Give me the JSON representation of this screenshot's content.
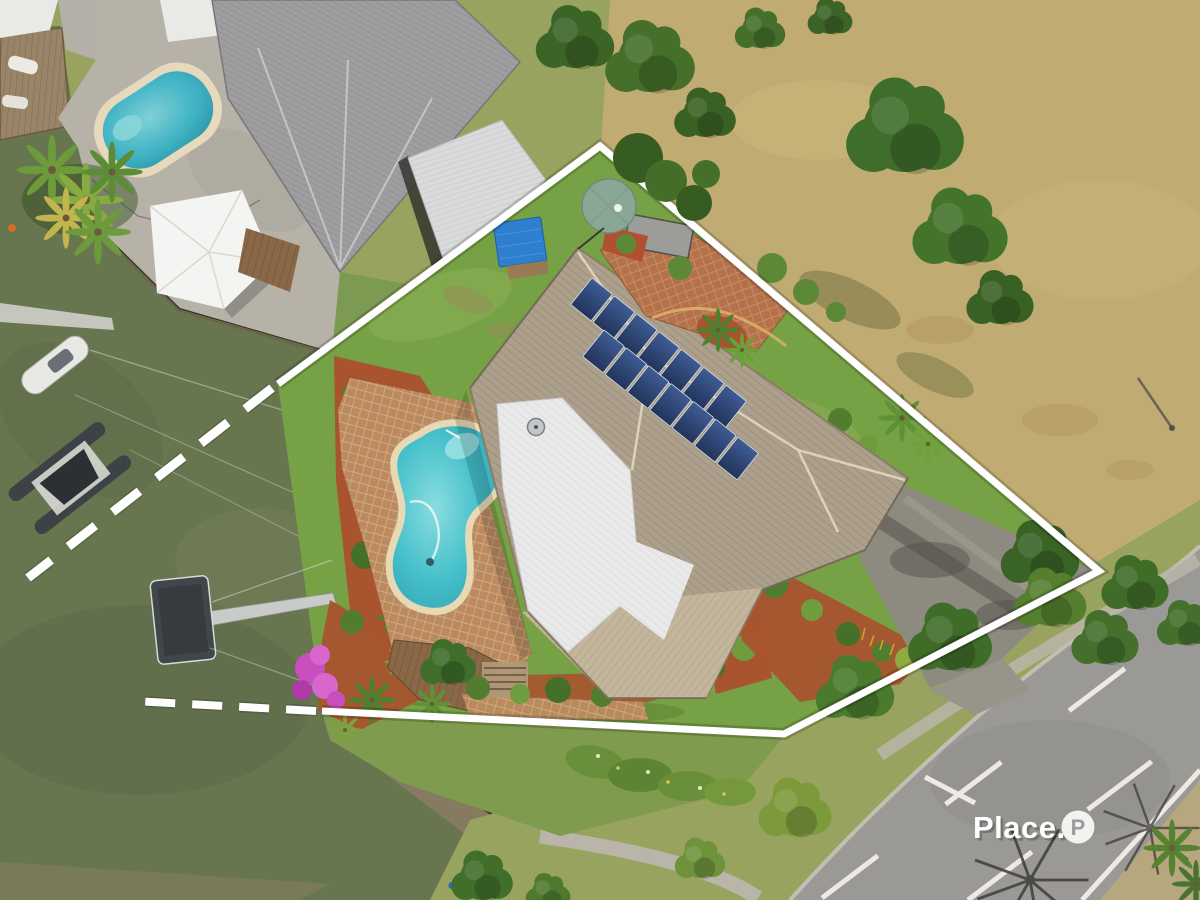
{
  "watermark": {
    "brand": "Place.",
    "badge_letter": "P"
  },
  "palette": {
    "water": "#68764f",
    "water_dark": "#5968444",
    "water_shallow": "#8a7f5f",
    "rocks": "#857b61",
    "seawall": "#23261f",
    "deck_concrete": "#b6b2a8",
    "dock_timber": "#9a8468",
    "lawn": "#76a145",
    "front_lawn": "#7f9c4e",
    "verge_grass": "#97a35e",
    "neighbor_lawn": "#7d9a52",
    "field": "#c0ab72",
    "road": "#9b9995",
    "road_marking": "#eceae3",
    "footpath": "#bab5a9",
    "kerb": "#c6c2b8",
    "neighbor_roof_grey": "#9e9ea0",
    "neighbor_garage_roof": "#d9dadb",
    "gazebo_roof": "#f4f4f2",
    "house_white_roof": "#e9e9ea",
    "tile_roof": "#aca08c",
    "tile_roof_light": "#c4b69c",
    "ridge_cap": "#e3d7c0",
    "solar_panel_dark": "#22345a",
    "solar_panel_light": "#3e5c94",
    "brick_paving": "#b5714c",
    "pool_paver": "#bc8a60",
    "brick_edging": "#d9b066",
    "red_mulch": "#a8542e",
    "shrub_green": "#527c2e",
    "shrub_light": "#6f9c3c",
    "tree_green": "#3f6d2a",
    "tree_light": "#557f2f",
    "tree_yellow": "#7c9a3c",
    "palm_green": "#5f9232",
    "bougainvillea": "#c94fc0",
    "water_tank": "#8aa795",
    "shed_blue": "#2f7fd0",
    "pergola_timber": "#b09a78",
    "deck_timber": "#8a6847",
    "pontoon": "#41464b",
    "walkway": "#c9cbc9",
    "boat_hull": "#3c4246",
    "drive_shade": "#8d8a80",
    "boundary_line": "#ffffff",
    "logo_text": "#ffffff",
    "logo_badge_bg": "#ffffff",
    "logo_badge_letter": "#9b9b9b"
  }
}
